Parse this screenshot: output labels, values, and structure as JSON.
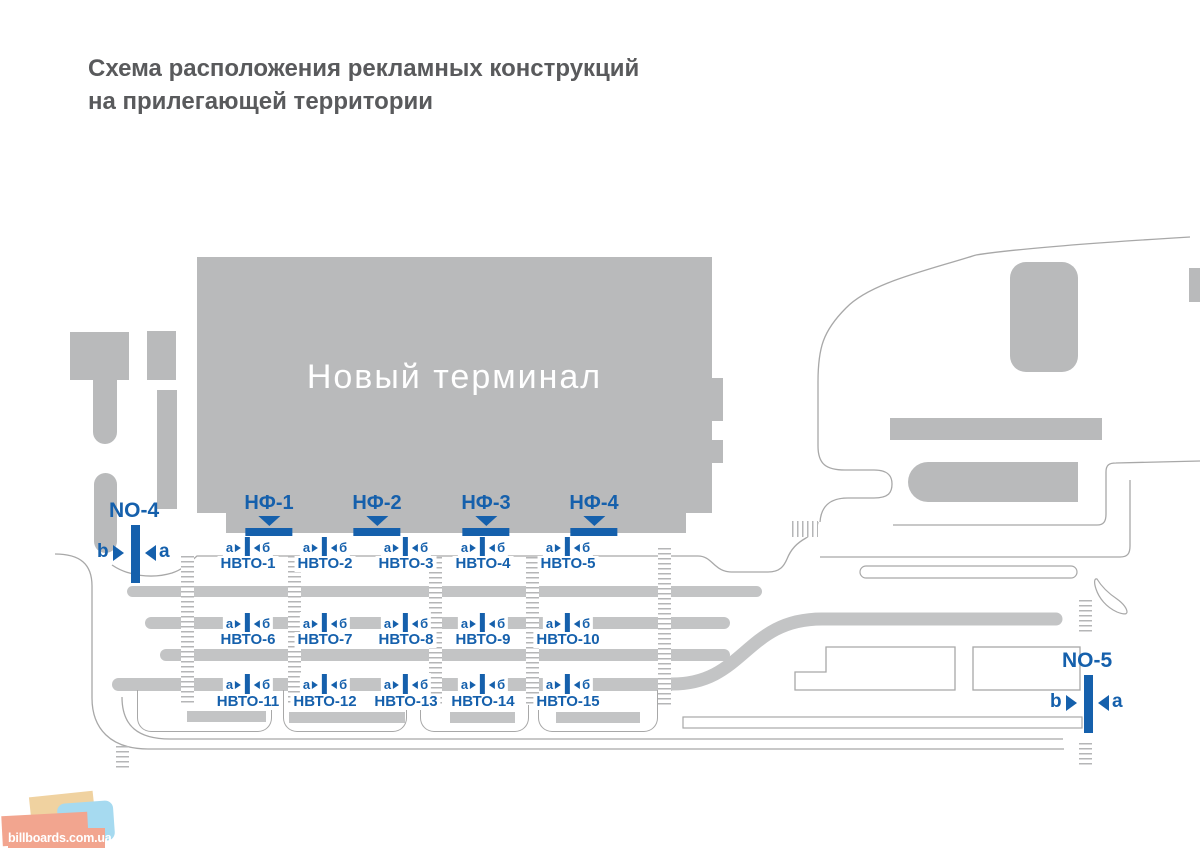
{
  "title": {
    "line1": "Схема расположения рекламных конструкций",
    "line2": "на прилегающей территории"
  },
  "terminal": {
    "label": "Новый терминал"
  },
  "marker_letters": {
    "left": "а",
    "right": "б"
  },
  "facade_signs": [
    {
      "id": "НФ-1",
      "cx": 269
    },
    {
      "id": "НФ-2",
      "cx": 377
    },
    {
      "id": "НФ-3",
      "cx": 486
    },
    {
      "id": "НФ-4",
      "cx": 594
    }
  ],
  "ground_sign_rows": [
    {
      "marker_y": 536,
      "label_y": 556,
      "signs": [
        {
          "id": "НВТО-1",
          "cx": 248
        },
        {
          "id": "НВТО-2",
          "cx": 325
        },
        {
          "id": "НВТО-3",
          "cx": 406
        },
        {
          "id": "НВТО-4",
          "cx": 483
        },
        {
          "id": "НВТО-5",
          "cx": 568
        }
      ]
    },
    {
      "marker_y": 612,
      "label_y": 632,
      "signs": [
        {
          "id": "НВТО-6",
          "cx": 248
        },
        {
          "id": "НВТО-7",
          "cx": 325
        },
        {
          "id": "НВТО-8",
          "cx": 406
        },
        {
          "id": "НВТО-9",
          "cx": 483
        },
        {
          "id": "НВТО-10",
          "cx": 568
        }
      ]
    },
    {
      "marker_y": 673,
      "label_y": 694,
      "signs": [
        {
          "id": "НВТО-11",
          "cx": 248
        },
        {
          "id": "НВТО-12",
          "cx": 325
        },
        {
          "id": "НВТО-13",
          "cx": 406
        },
        {
          "id": "НВТО-14",
          "cx": 483
        },
        {
          "id": "НВТО-15",
          "cx": 568
        }
      ]
    }
  ],
  "roadside_signs": [
    {
      "id": "NO-4",
      "left_letter": "b",
      "right_letter": "a",
      "x": 95,
      "y": 499
    },
    {
      "id": "NO-5",
      "left_letter": "b",
      "right_letter": "a",
      "x": 1048,
      "y": 649
    }
  ],
  "watermark": {
    "text": "billboards.com.ua"
  },
  "colors": {
    "accent_blue": "#1560ac",
    "building_gray": "#b9babb",
    "lane_gray": "#c3c4c5",
    "road_line_gray": "#a8a8a8",
    "title_gray": "#595a5c",
    "logo_salmon": "#f2a58f",
    "logo_blue": "#a6daf0",
    "logo_tan": "#f0d2a0"
  }
}
